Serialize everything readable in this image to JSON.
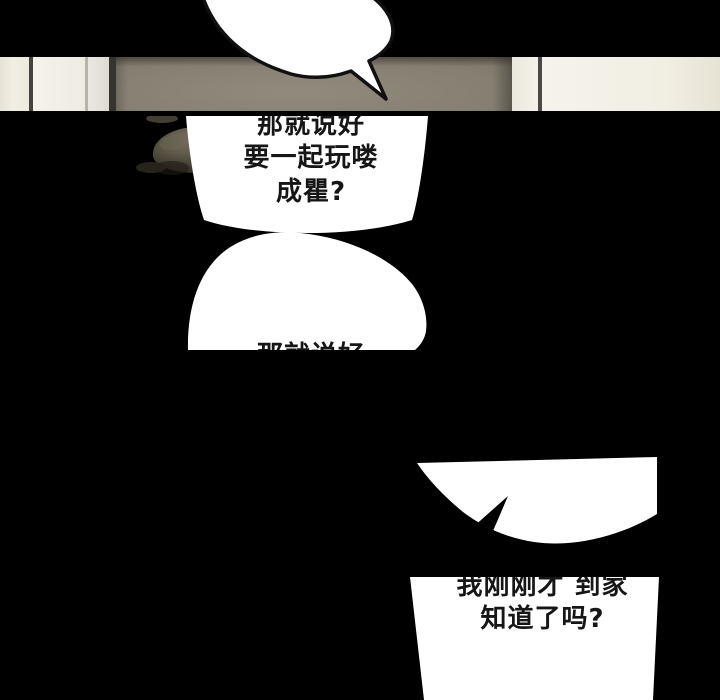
{
  "page": {
    "kind": "webtoon-comic-page",
    "background_color": "#000000"
  },
  "panel": {
    "wall_color": "#8b8577",
    "door_panel_color": "#f1eee2",
    "frame_line_color": "#44433e",
    "character_hair_color": "#5d5747"
  },
  "bubbles": {
    "top": {
      "lines": [],
      "outline_color": "#101010",
      "fill": "#ffffff"
    },
    "second": {
      "lines": [
        "那就说好",
        "要一起玩喽",
        "成瞿?"
      ],
      "fill": "#ffffff",
      "text_color": "#161616"
    },
    "third": {
      "lines": [
        "那就说好"
      ],
      "fill": "#ffffff",
      "text_color": "#161616"
    },
    "fourth": {
      "lines": [],
      "fill": "#ffffff",
      "tail_color": "#000000"
    },
    "fifth": {
      "lines": [
        "我刚刚才 到家",
        "知道了吗?"
      ],
      "fill": "#ffffff",
      "text_color": "#161616"
    }
  }
}
